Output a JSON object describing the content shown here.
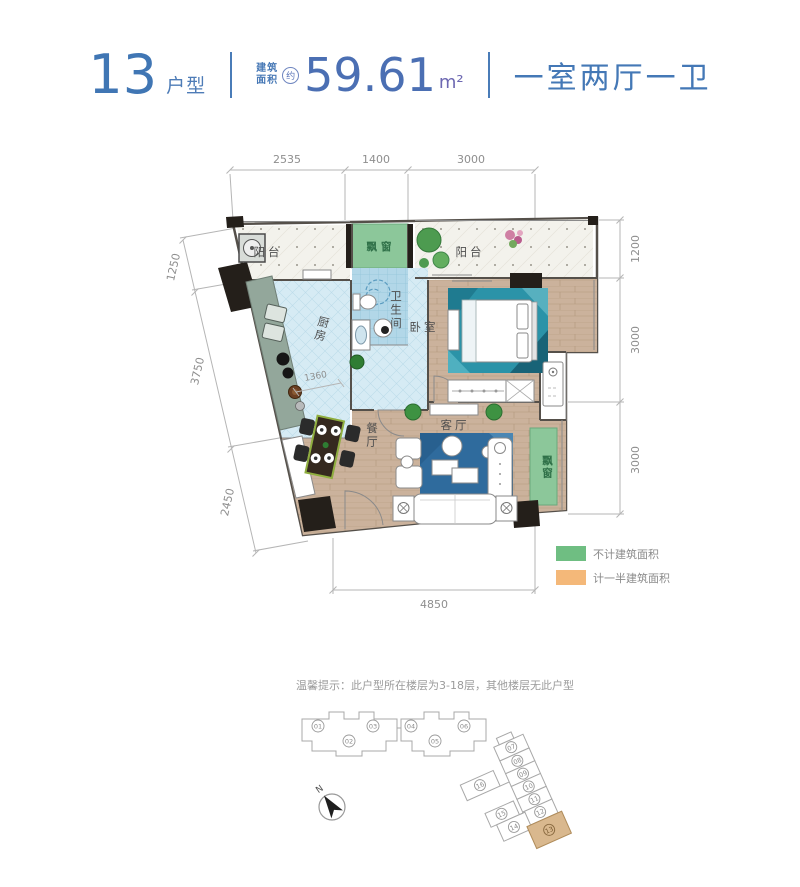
{
  "header": {
    "unit_number": "13",
    "unit_type_label": "户型",
    "area_prefix_top": "建筑",
    "area_prefix_bottom": "面积",
    "area_approx_mark": "约",
    "area_value": "59.61",
    "area_unit": "m²",
    "layout_summary": "一室两厅一卫"
  },
  "dims": {
    "top": [
      "2535",
      "1400",
      "3000"
    ],
    "right": [
      "1200",
      "3000",
      "3000"
    ],
    "left": [
      "1250",
      "3750",
      "2450"
    ],
    "bottom": "4850",
    "kitchen_inner": "1360"
  },
  "rooms": {
    "balcony_left": "阳台",
    "balcony_right": "阳台",
    "bay_window_top": "飘窗",
    "bay_window_right": "飘窗",
    "kitchen": "厨房",
    "bathroom": "卫生间",
    "bedroom": "卧室",
    "dining": "餐厅",
    "living": "客厅"
  },
  "legend": {
    "items": [
      {
        "label": "不计建筑面积",
        "color": "#6fbe82"
      },
      {
        "label": "计一半建筑面积",
        "color": "#f4b879"
      }
    ]
  },
  "note": "温馨提示：此户型所在楼层为3-18层，其他楼层无此户型",
  "site_plan": {
    "building_a_units": [
      "01",
      "02",
      "03",
      "04",
      "05",
      "06"
    ],
    "building_b_units": [
      "07",
      "08",
      "09",
      "10",
      "11",
      "12",
      "13",
      "14",
      "15",
      "16"
    ],
    "highlighted_unit": "13",
    "highlight_color": "#d9b88e"
  },
  "compass": {
    "north_label": "N"
  },
  "colors": {
    "bay_green": "#8cc79a",
    "legend_green": "#6fbe82",
    "legend_orange": "#f4b879"
  }
}
